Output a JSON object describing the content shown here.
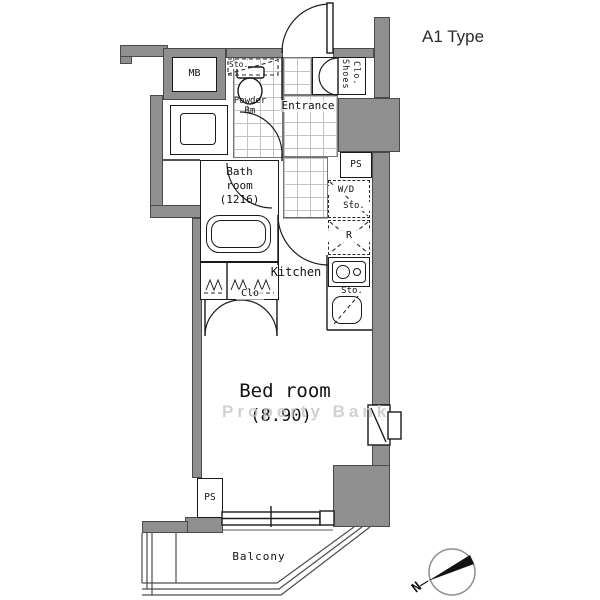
{
  "header": {
    "plan_type_label": "A1 Type"
  },
  "watermark_text": "Property Bank",
  "rooms": {
    "entrance_label": "Entrance",
    "powder_room_line1": "Powder",
    "powder_room_line2": "Rm",
    "bath_room_line1": "Bath",
    "bath_room_line2": "room",
    "bath_room_size": "(1216)",
    "kitchen_label": "Kitchen",
    "bedroom_label": "Bed room",
    "bedroom_size": "(8.90)",
    "balcony_label": "Balcony",
    "closet_label": "Clo"
  },
  "fixtures": {
    "meter_box_label": "MB",
    "shoes_closet_line1": "Shoes",
    "shoes_closet_line2": "Clo.",
    "powder_storage_label": "Sto.",
    "washer_dryer_line1": "W/D",
    "washer_dryer_line2": "Sto.",
    "refrigerator_label": "R",
    "kitchen_storage_label": "Sto.",
    "pipe_space_right_label": "PS",
    "pipe_space_bottom_label": "PS"
  },
  "compass": {
    "north_label": "N"
  },
  "colors": {
    "wall_fill": "#8f8f8f",
    "line": "#1a1a1a",
    "tile_grid": "#c3c3c3",
    "watermark": "#c6c6c6"
  }
}
